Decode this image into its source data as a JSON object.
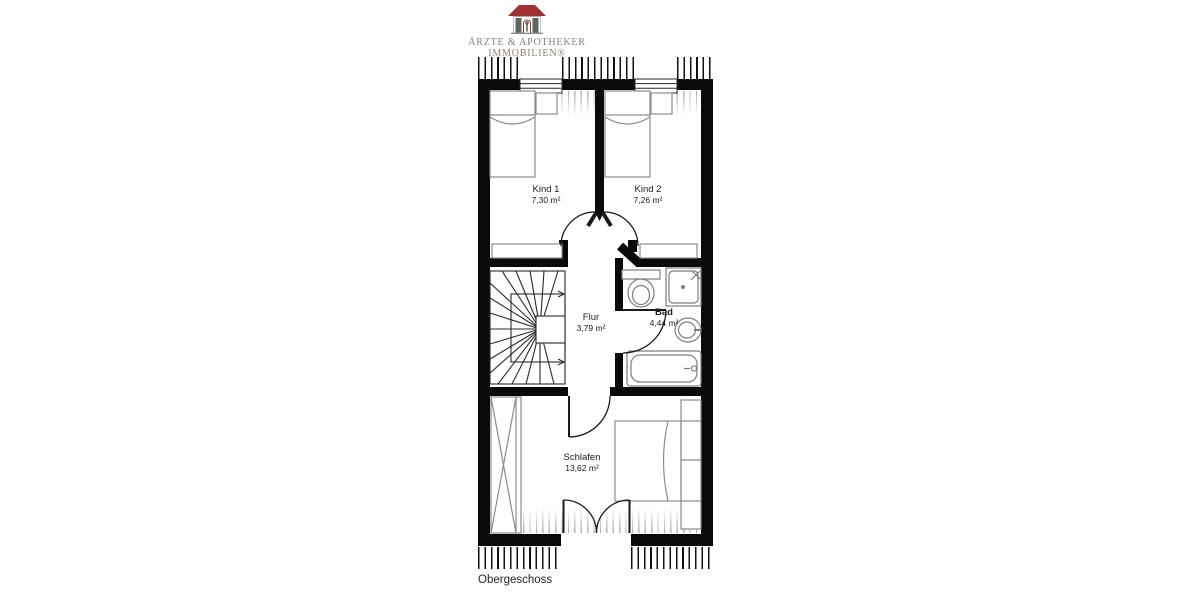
{
  "logo": {
    "line1": "ÄRZTE & APOTHEKER",
    "line2": "IMMOBILIEN®"
  },
  "floor_label": "Obergeschoss",
  "rooms": [
    {
      "id": "kind1",
      "name": "Kind 1",
      "area": "7,30 m²"
    },
    {
      "id": "kind2",
      "name": "Kind 2",
      "area": "7,26 m²"
    },
    {
      "id": "flur",
      "name": "Flur",
      "area": "3,79 m²"
    },
    {
      "id": "bad",
      "name": "Bad",
      "area": "4,44 m²"
    },
    {
      "id": "schlafen",
      "name": "Schlafen",
      "area": "13,62 m²"
    }
  ],
  "colors": {
    "wall": "#0a0a0a",
    "furniture_line": "#8c8c8c",
    "roof": "#9d3134",
    "pillar": "#5f665e",
    "logo_text": "#8b8174"
  }
}
